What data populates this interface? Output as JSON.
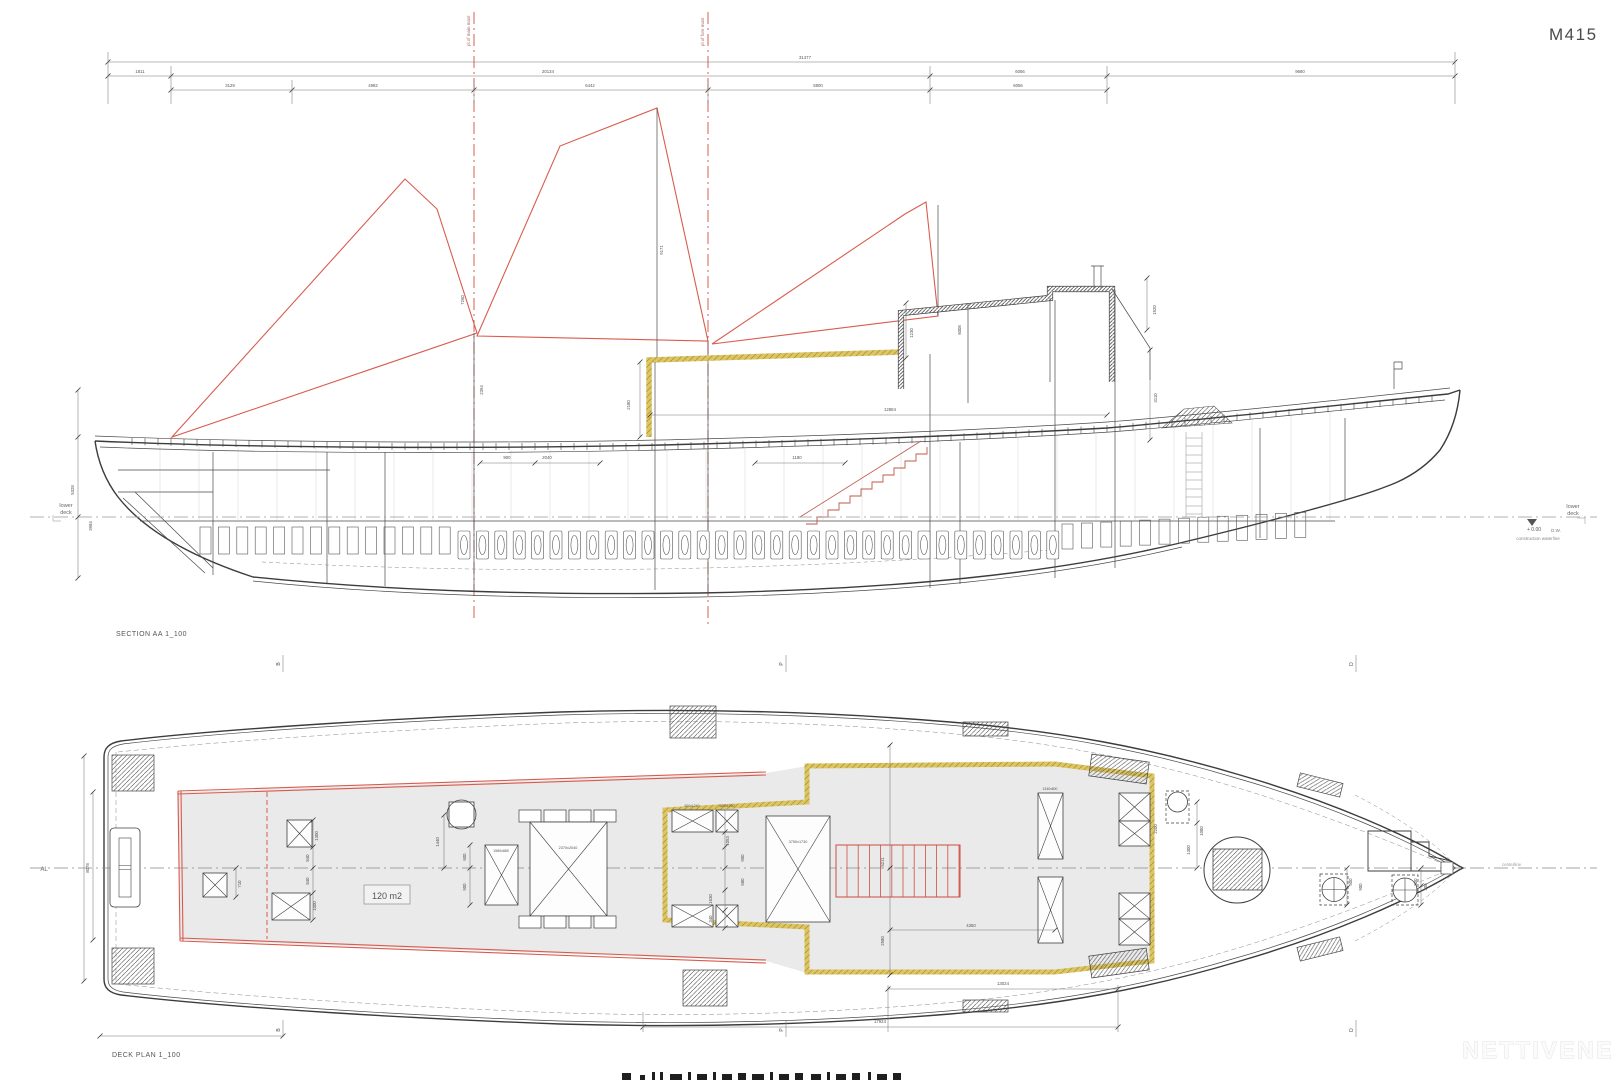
{
  "drawing": {
    "number": "M415",
    "watermark": "NETTIVENE"
  },
  "section": {
    "title": "SECTION AA  1_100",
    "lower_deck_l1": "lower",
    "lower_deck_l2": "deck",
    "lower_deck_r1": "lower",
    "lower_deck_r2": "deck",
    "datum": "+ 0.00",
    "datum_ref": "D.W.",
    "waterline_note": "construction waterline",
    "mast_label_aft": "pl.of main mast",
    "mast_label_fore": "pl.of fore mast"
  },
  "deck": {
    "title": "DECK PLAN  1_100",
    "area": "120 m2",
    "centerline": "centerline",
    "grid_left": "AL"
  },
  "dim_labels": {
    "top_chain": [
      {
        "t": "31477",
        "x": 805,
        "y": 59
      },
      {
        "t": "1811",
        "x": 140,
        "y": 73
      },
      {
        "t": "20134",
        "x": 548,
        "y": 73
      },
      {
        "t": "6056",
        "x": 1020,
        "y": 73
      },
      {
        "t": "9680",
        "x": 1300,
        "y": 73
      },
      {
        "t": "3129",
        "x": 230,
        "y": 87
      },
      {
        "t": "4982",
        "x": 373,
        "y": 87
      },
      {
        "t": "6442",
        "x": 590,
        "y": 87
      },
      {
        "t": "5800",
        "x": 818,
        "y": 87
      },
      {
        "t": "6056",
        "x": 1018,
        "y": 87
      }
    ],
    "section": [
      {
        "t": "7260",
        "x": 464,
        "y": 300,
        "r": -90
      },
      {
        "t": "2394",
        "x": 483,
        "y": 390,
        "r": -90
      },
      {
        "t": "9171",
        "x": 663,
        "y": 250,
        "r": -90
      },
      {
        "t": "2180",
        "x": 630,
        "y": 405,
        "r": -90
      },
      {
        "t": "12884",
        "x": 890,
        "y": 411
      },
      {
        "t": "1230",
        "x": 913,
        "y": 333,
        "r": -90
      },
      {
        "t": "6008",
        "x": 961,
        "y": 330,
        "r": -90
      },
      {
        "t": "1520",
        "x": 1156,
        "y": 310,
        "r": -90
      },
      {
        "t": "3110",
        "x": 1157,
        "y": 398,
        "r": -90
      },
      {
        "t": "900",
        "x": 507,
        "y": 459
      },
      {
        "t": "2040",
        "x": 547,
        "y": 459
      },
      {
        "t": "1180",
        "x": 797,
        "y": 459
      },
      {
        "t": "5328",
        "x": 74,
        "y": 490,
        "r": -90
      },
      {
        "t": "3984",
        "x": 92,
        "y": 526,
        "r": -90
      }
    ],
    "deck": [
      {
        "t": "8078",
        "x": 89,
        "y": 868,
        "r": -90
      },
      {
        "t": "710",
        "x": 241,
        "y": 884,
        "r": -90
      },
      {
        "t": "1300",
        "x": 318,
        "y": 836,
        "r": -90
      },
      {
        "t": "840",
        "x": 309,
        "y": 858,
        "r": -90
      },
      {
        "t": "840",
        "x": 309,
        "y": 881,
        "r": -90
      },
      {
        "t": "1000",
        "x": 316,
        "y": 906,
        "r": -90
      },
      {
        "t": "1440",
        "x": 439,
        "y": 842,
        "r": -90
      },
      {
        "t": "600",
        "x": 466,
        "y": 857,
        "r": -90
      },
      {
        "t": "900",
        "x": 466,
        "y": 887,
        "r": -90
      },
      {
        "t": "1580x880",
        "x": 501,
        "y": 852,
        "s": 3.6
      },
      {
        "t": "2370x2040",
        "x": 568,
        "y": 849,
        "s": 3.8
      },
      {
        "t": "600x1240",
        "x": 692,
        "y": 807,
        "s": 3.4
      },
      {
        "t": "600x1240",
        "x": 727,
        "y": 807,
        "s": 3.4
      },
      {
        "t": "3750x1730",
        "x": 798,
        "y": 843,
        "s": 3.8
      },
      {
        "t": "1340x800",
        "x": 1050,
        "y": 790,
        "s": 3.4
      },
      {
        "t": "1053",
        "x": 729,
        "y": 841,
        "r": -90
      },
      {
        "t": "900",
        "x": 744,
        "y": 858,
        "r": -90
      },
      {
        "t": "580",
        "x": 744,
        "y": 882,
        "r": -90
      },
      {
        "t": "1630",
        "x": 712,
        "y": 899,
        "r": -90
      },
      {
        "t": "340",
        "x": 712,
        "y": 919,
        "r": -90
      },
      {
        "t": "5211",
        "x": 884,
        "y": 862,
        "r": -90
      },
      {
        "t": "2580",
        "x": 884,
        "y": 941,
        "r": -90
      },
      {
        "t": "4350",
        "x": 971,
        "y": 927
      },
      {
        "t": "2200",
        "x": 1157,
        "y": 829,
        "r": -90
      },
      {
        "t": "1080",
        "x": 1203,
        "y": 831,
        "r": -90
      },
      {
        "t": "1300",
        "x": 1190,
        "y": 850,
        "r": -90
      },
      {
        "t": "500",
        "x": 1352,
        "y": 882,
        "r": -90
      },
      {
        "t": "900",
        "x": 1362,
        "y": 887,
        "r": -90
      },
      {
        "t": "800",
        "x": 1417,
        "y": 882,
        "r": -90
      },
      {
        "t": "300",
        "x": 1427,
        "y": 887,
        "r": -90
      },
      {
        "t": "13024",
        "x": 1003,
        "y": 985
      },
      {
        "t": "17924",
        "x": 880,
        "y": 1023
      }
    ],
    "markers": [
      {
        "t": "B",
        "x": 280,
        "y": 664,
        "r": -90,
        "s": 5
      },
      {
        "t": "P",
        "x": 783,
        "y": 664,
        "r": -90,
        "s": 5
      },
      {
        "t": "D",
        "x": 1353,
        "y": 664,
        "r": -90,
        "s": 5
      },
      {
        "t": "B",
        "x": 280,
        "y": 1030,
        "r": -90,
        "s": 5
      },
      {
        "t": "P",
        "x": 783,
        "y": 1030,
        "r": -90,
        "s": 5
      },
      {
        "t": "D",
        "x": 1353,
        "y": 1030,
        "r": -90,
        "s": 5
      }
    ]
  },
  "deck_items": [
    {
      "type": "tiller",
      "x": 110,
      "y": 828,
      "w": 30,
      "h": 79
    },
    {
      "type": "hatch",
      "x": 112,
      "y": 755,
      "w": 42,
      "h": 36
    },
    {
      "type": "hatch",
      "x": 112,
      "y": 948,
      "w": 42,
      "h": 36
    },
    {
      "type": "xbox",
      "x": 203,
      "y": 873,
      "w": 24,
      "h": 24
    },
    {
      "type": "xbox",
      "x": 287,
      "y": 820,
      "w": 25,
      "h": 27
    },
    {
      "type": "xbox",
      "x": 272,
      "y": 893,
      "w": 38,
      "h": 27
    },
    {
      "type": "circle_sq",
      "x": 449,
      "y": 802,
      "w": 25,
      "h": 25
    },
    {
      "type": "xbox",
      "x": 485,
      "y": 845,
      "w": 33,
      "h": 60
    },
    {
      "type": "rect",
      "x": 519,
      "y": 810,
      "w": 22,
      "h": 12
    },
    {
      "type": "rect",
      "x": 544,
      "y": 810,
      "w": 22,
      "h": 12
    },
    {
      "type": "rect",
      "x": 569,
      "y": 810,
      "w": 22,
      "h": 12
    },
    {
      "type": "rect",
      "x": 594,
      "y": 810,
      "w": 22,
      "h": 12
    },
    {
      "type": "xbox",
      "x": 530,
      "y": 822,
      "w": 77,
      "h": 94
    },
    {
      "type": "rect",
      "x": 519,
      "y": 916,
      "w": 22,
      "h": 12
    },
    {
      "type": "rect",
      "x": 544,
      "y": 916,
      "w": 22,
      "h": 12
    },
    {
      "type": "rect",
      "x": 569,
      "y": 916,
      "w": 22,
      "h": 12
    },
    {
      "type": "rect",
      "x": 594,
      "y": 916,
      "w": 22,
      "h": 12
    },
    {
      "type": "xbox",
      "x": 672,
      "y": 810,
      "w": 41,
      "h": 22
    },
    {
      "type": "xbox",
      "x": 716,
      "y": 810,
      "w": 22,
      "h": 22
    },
    {
      "type": "xbox",
      "x": 672,
      "y": 905,
      "w": 41,
      "h": 22
    },
    {
      "type": "xbox",
      "x": 716,
      "y": 905,
      "w": 22,
      "h": 22
    },
    {
      "type": "xbox",
      "x": 766,
      "y": 816,
      "w": 64,
      "h": 106
    },
    {
      "type": "xbox",
      "x": 1038,
      "y": 793,
      "w": 25,
      "h": 66
    },
    {
      "type": "xbox",
      "x": 1038,
      "y": 877,
      "w": 25,
      "h": 66
    },
    {
      "type": "xbox",
      "x": 1119,
      "y": 793,
      "w": 31,
      "h": 28
    },
    {
      "type": "xbox",
      "x": 1119,
      "y": 821,
      "w": 31,
      "h": 25
    },
    {
      "type": "xbox",
      "x": 1119,
      "y": 893,
      "w": 31,
      "h": 26
    },
    {
      "type": "xbox",
      "x": 1119,
      "y": 919,
      "w": 31,
      "h": 26
    },
    {
      "type": "vent",
      "x": 1166,
      "y": 791,
      "w": 23,
      "h": 32
    },
    {
      "type": "funnel",
      "cx": 1237,
      "cy": 870,
      "r": 33,
      "sx": 1213,
      "sy": 849,
      "sw": 49,
      "sh": 41
    },
    {
      "type": "capstan",
      "x": 1320,
      "y": 874,
      "w": 28,
      "h": 31
    },
    {
      "type": "capstan",
      "x": 1392,
      "y": 875,
      "w": 26,
      "h": 30
    },
    {
      "type": "rect",
      "x": 1441,
      "y": 862,
      "w": 12,
      "h": 12
    },
    {
      "type": "hatch",
      "x": 670,
      "y": 706,
      "w": 46,
      "h": 32
    },
    {
      "type": "hatch",
      "x": 683,
      "y": 970,
      "w": 44,
      "h": 36
    },
    {
      "type": "hatch",
      "x": 963,
      "y": 722,
      "w": 45,
      "h": 14
    },
    {
      "type": "hatch",
      "x": 963,
      "y": 1000,
      "w": 45,
      "h": 12
    },
    {
      "type": "hatch",
      "x": 1090,
      "y": 758,
      "w": 58,
      "h": 22,
      "rot": 8
    },
    {
      "type": "hatch",
      "x": 1090,
      "y": 952,
      "w": 58,
      "h": 22,
      "rot": -8
    },
    {
      "type": "hatch",
      "x": 1298,
      "y": 778,
      "w": 44,
      "h": 14,
      "rot": 14
    },
    {
      "type": "hatch",
      "x": 1298,
      "y": 942,
      "w": 44,
      "h": 14,
      "rot": -14
    }
  ],
  "colors": {
    "accent_red": "#d85c4e",
    "highlight_yellow": "#d8c258",
    "deck_fill": "#eaeaea",
    "line": "#3c3c3c"
  }
}
